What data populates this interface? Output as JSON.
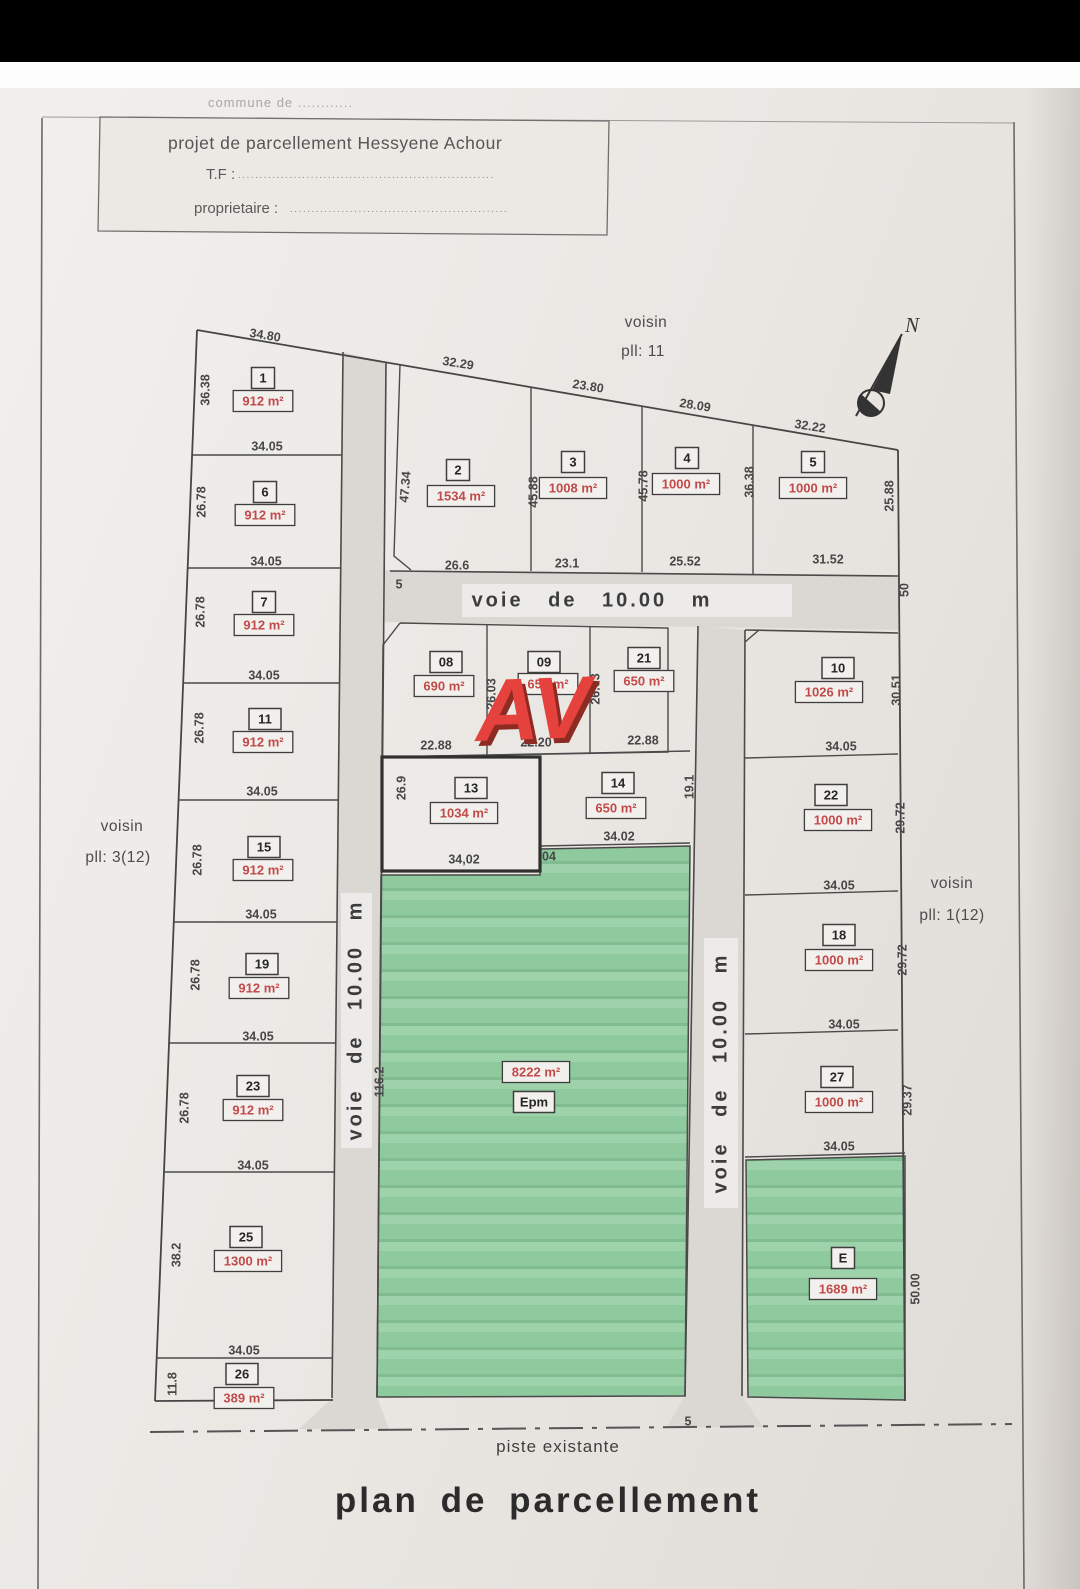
{
  "title_block": {
    "commune": "commune de ............",
    "project": "projet de parcellement Hessyene Achour",
    "tf_label": "T.F :",
    "tf_dots": "............................................................",
    "owner_label": "proprietaire :",
    "owner_dots": "..................................................."
  },
  "compass": {
    "north": "N"
  },
  "neighbors": {
    "top1": "voisin",
    "top2": "pll: 11",
    "left1": "voisin",
    "left2": "pll: 3(12)",
    "right1": "voisin",
    "right2": "pll: 1(12)"
  },
  "watermark": "AV",
  "roads": {
    "horizontal": "voie de 10.00 m",
    "vertical_left": "voie de 10.00 m",
    "vertical_right": "voie de 10.00 m"
  },
  "footer": {
    "piste": "piste existante",
    "plan_title": "plan de parcellement"
  },
  "plan": {
    "parcels": [
      {
        "id": "1",
        "num": "1",
        "nx": 263,
        "ny": 378,
        "area": "912 m²",
        "ax": 263,
        "ay": 401
      },
      {
        "id": "6",
        "num": "6",
        "nx": 265,
        "ny": 492,
        "area": "912 m²",
        "ax": 265,
        "ay": 515
      },
      {
        "id": "7",
        "num": "7",
        "nx": 264,
        "ny": 602,
        "area": "912 m²",
        "ax": 264,
        "ay": 625
      },
      {
        "id": "11",
        "num": "11",
        "nx": 265,
        "ny": 719,
        "area": "912 m²",
        "ax": 263,
        "ay": 742
      },
      {
        "id": "15",
        "num": "15",
        "nx": 264,
        "ny": 847,
        "area": "912 m²",
        "ax": 263,
        "ay": 870
      },
      {
        "id": "19",
        "num": "19",
        "nx": 262,
        "ny": 964,
        "area": "912 m²",
        "ax": 259,
        "ay": 988
      },
      {
        "id": "23",
        "num": "23",
        "nx": 253,
        "ny": 1086,
        "area": "912 m²",
        "ax": 253,
        "ay": 1110
      },
      {
        "id": "25",
        "num": "25",
        "nx": 246,
        "ny": 1237,
        "area": "1300 m²",
        "ax": 248,
        "ay": 1261
      },
      {
        "id": "26",
        "num": "26",
        "nx": 242,
        "ny": 1374,
        "area": "389 m²",
        "ax": 244,
        "ay": 1398
      },
      {
        "id": "2",
        "num": "2",
        "nx": 458,
        "ny": 470,
        "area": "1534 m²",
        "ax": 461,
        "ay": 496
      },
      {
        "id": "3",
        "num": "3",
        "nx": 573,
        "ny": 462,
        "area": "1008 m²",
        "ax": 573,
        "ay": 488
      },
      {
        "id": "4",
        "num": "4",
        "nx": 687,
        "ny": 458,
        "area": "1000 m²",
        "ax": 686,
        "ay": 484
      },
      {
        "id": "5",
        "num": "5",
        "nx": 813,
        "ny": 462,
        "area": "1000 m²",
        "ax": 813,
        "ay": 488
      },
      {
        "id": "08",
        "num": "08",
        "nx": 446,
        "ny": 662,
        "area": "690 m²",
        "ax": 444,
        "ay": 686
      },
      {
        "id": "09",
        "num": "09",
        "nx": 544,
        "ny": 662,
        "area": "650 m²",
        "ax": 548,
        "ay": 684
      },
      {
        "id": "21",
        "num": "21",
        "nx": 644,
        "ny": 658,
        "area": "650 m²",
        "ax": 644,
        "ay": 681
      },
      {
        "id": "13",
        "num": "13",
        "nx": 471,
        "ny": 788,
        "area": "1034 m²",
        "ax": 464,
        "ay": 813
      },
      {
        "id": "14",
        "num": "14",
        "nx": 618,
        "ny": 783,
        "area": "650 m²",
        "ax": 616,
        "ay": 808
      },
      {
        "id": "10",
        "num": "10",
        "nx": 838,
        "ny": 668,
        "area": "1026 m²",
        "ax": 829,
        "ay": 692
      },
      {
        "id": "22",
        "num": "22",
        "nx": 831,
        "ny": 795,
        "area": "1000 m²",
        "ax": 838,
        "ay": 820
      },
      {
        "id": "18",
        "num": "18",
        "nx": 839,
        "ny": 935,
        "area": "1000 m²",
        "ax": 839,
        "ay": 960
      },
      {
        "id": "27",
        "num": "27",
        "nx": 837,
        "ny": 1077,
        "area": "1000 m²",
        "ax": 839,
        "ay": 1102
      },
      {
        "id": "E",
        "num": "E",
        "nx": 843,
        "ny": 1258,
        "area": "1689 m²",
        "ax": 843,
        "ay": 1289
      },
      {
        "id": "Epm",
        "num": "Epm",
        "nx": 534,
        "ny": 1102,
        "area": "8222 m²",
        "ax": 536,
        "ay": 1072
      }
    ],
    "dims": [
      {
        "t": "34.80",
        "x": 265,
        "y": 336,
        "r": 9
      },
      {
        "t": "32.29",
        "x": 458,
        "y": 364,
        "r": 9
      },
      {
        "t": "23.80",
        "x": 588,
        "y": 387,
        "r": 9
      },
      {
        "t": "28.09",
        "x": 695,
        "y": 406,
        "r": 9
      },
      {
        "t": "32.22",
        "x": 810,
        "y": 427,
        "r": 9
      },
      {
        "t": "36.38",
        "x": 206,
        "y": 390,
        "r": -90
      },
      {
        "t": "26.78",
        "x": 202,
        "y": 502,
        "r": -90
      },
      {
        "t": "26.78",
        "x": 201,
        "y": 612,
        "r": -90
      },
      {
        "t": "26.78",
        "x": 200,
        "y": 728,
        "r": -90
      },
      {
        "t": "26.78",
        "x": 198,
        "y": 860,
        "r": -90
      },
      {
        "t": "26.78",
        "x": 196,
        "y": 975,
        "r": -90
      },
      {
        "t": "26.78",
        "x": 185,
        "y": 1108,
        "r": -90
      },
      {
        "t": "38.2",
        "x": 177,
        "y": 1255,
        "r": -90
      },
      {
        "t": "11.8",
        "x": 173,
        "y": 1384,
        "r": -90
      },
      {
        "t": "34.05",
        "x": 267,
        "y": 447,
        "r": 0
      },
      {
        "t": "34.05",
        "x": 266,
        "y": 562,
        "r": 0
      },
      {
        "t": "34.05",
        "x": 264,
        "y": 676,
        "r": 0
      },
      {
        "t": "34.05",
        "x": 262,
        "y": 792,
        "r": 0
      },
      {
        "t": "34.05",
        "x": 261,
        "y": 915,
        "r": 0
      },
      {
        "t": "34.05",
        "x": 258,
        "y": 1037,
        "r": 0
      },
      {
        "t": "34.05",
        "x": 253,
        "y": 1166,
        "r": 0
      },
      {
        "t": "34.05",
        "x": 244,
        "y": 1351,
        "r": 0
      },
      {
        "t": "26.6",
        "x": 457,
        "y": 566,
        "r": 0
      },
      {
        "t": "23.1",
        "x": 567,
        "y": 564,
        "r": 0
      },
      {
        "t": "25.52",
        "x": 685,
        "y": 562,
        "r": 0
      },
      {
        "t": "31.52",
        "x": 828,
        "y": 560,
        "r": 0
      },
      {
        "t": "47.34",
        "x": 406,
        "y": 487,
        "r": -85
      },
      {
        "t": "45.88",
        "x": 534,
        "y": 492,
        "r": -90
      },
      {
        "t": "45.78",
        "x": 644,
        "y": 486,
        "r": -90
      },
      {
        "t": "36.38",
        "x": 750,
        "y": 482,
        "r": -90
      },
      {
        "t": "25.88",
        "x": 890,
        "y": 496,
        "r": -90
      },
      {
        "t": "5",
        "x": 399,
        "y": 585,
        "r": 0
      },
      {
        "t": "22.88",
        "x": 436,
        "y": 746,
        "r": 0
      },
      {
        "t": "22.20",
        "x": 536,
        "y": 743,
        "r": 0
      },
      {
        "t": "22.88",
        "x": 643,
        "y": 741,
        "r": 0
      },
      {
        "t": "26.03",
        "x": 492,
        "y": 694,
        "r": -90
      },
      {
        "t": "26.03",
        "x": 596,
        "y": 689,
        "r": -90
      },
      {
        "t": "26.9",
        "x": 402,
        "y": 788,
        "r": -90
      },
      {
        "t": "34,02",
        "x": 464,
        "y": 860,
        "r": 0
      },
      {
        "t": "34.02",
        "x": 619,
        "y": 837,
        "r": 0
      },
      {
        "t": "19.1",
        "x": 690,
        "y": 787,
        "r": -90
      },
      {
        "t": "04",
        "x": 549,
        "y": 857,
        "r": 0
      },
      {
        "t": "50",
        "x": 905,
        "y": 590,
        "r": -90
      },
      {
        "t": "30.51",
        "x": 897,
        "y": 690,
        "r": -90
      },
      {
        "t": "29.72",
        "x": 901,
        "y": 818,
        "r": -90
      },
      {
        "t": "29.72",
        "x": 903,
        "y": 960,
        "r": -90
      },
      {
        "t": "29.37",
        "x": 908,
        "y": 1100,
        "r": -90
      },
      {
        "t": "50.00",
        "x": 916,
        "y": 1289,
        "r": -90
      },
      {
        "t": "34.05",
        "x": 841,
        "y": 747,
        "r": 0
      },
      {
        "t": "34.05",
        "x": 839,
        "y": 886,
        "r": 0
      },
      {
        "t": "34.05",
        "x": 844,
        "y": 1025,
        "r": 0
      },
      {
        "t": "34.05",
        "x": 839,
        "y": 1147,
        "r": 0
      },
      {
        "t": "116.2",
        "x": 380,
        "y": 1082,
        "r": -90
      },
      {
        "t": "5",
        "x": 688,
        "y": 1422,
        "r": 0
      }
    ]
  },
  "colors": {
    "area_text": "#c24a4a",
    "watermark": "#e5423d",
    "green": "#8fc99e",
    "road": "#dbd8d4",
    "line": "#464646",
    "paper": "#e9e6e2"
  }
}
